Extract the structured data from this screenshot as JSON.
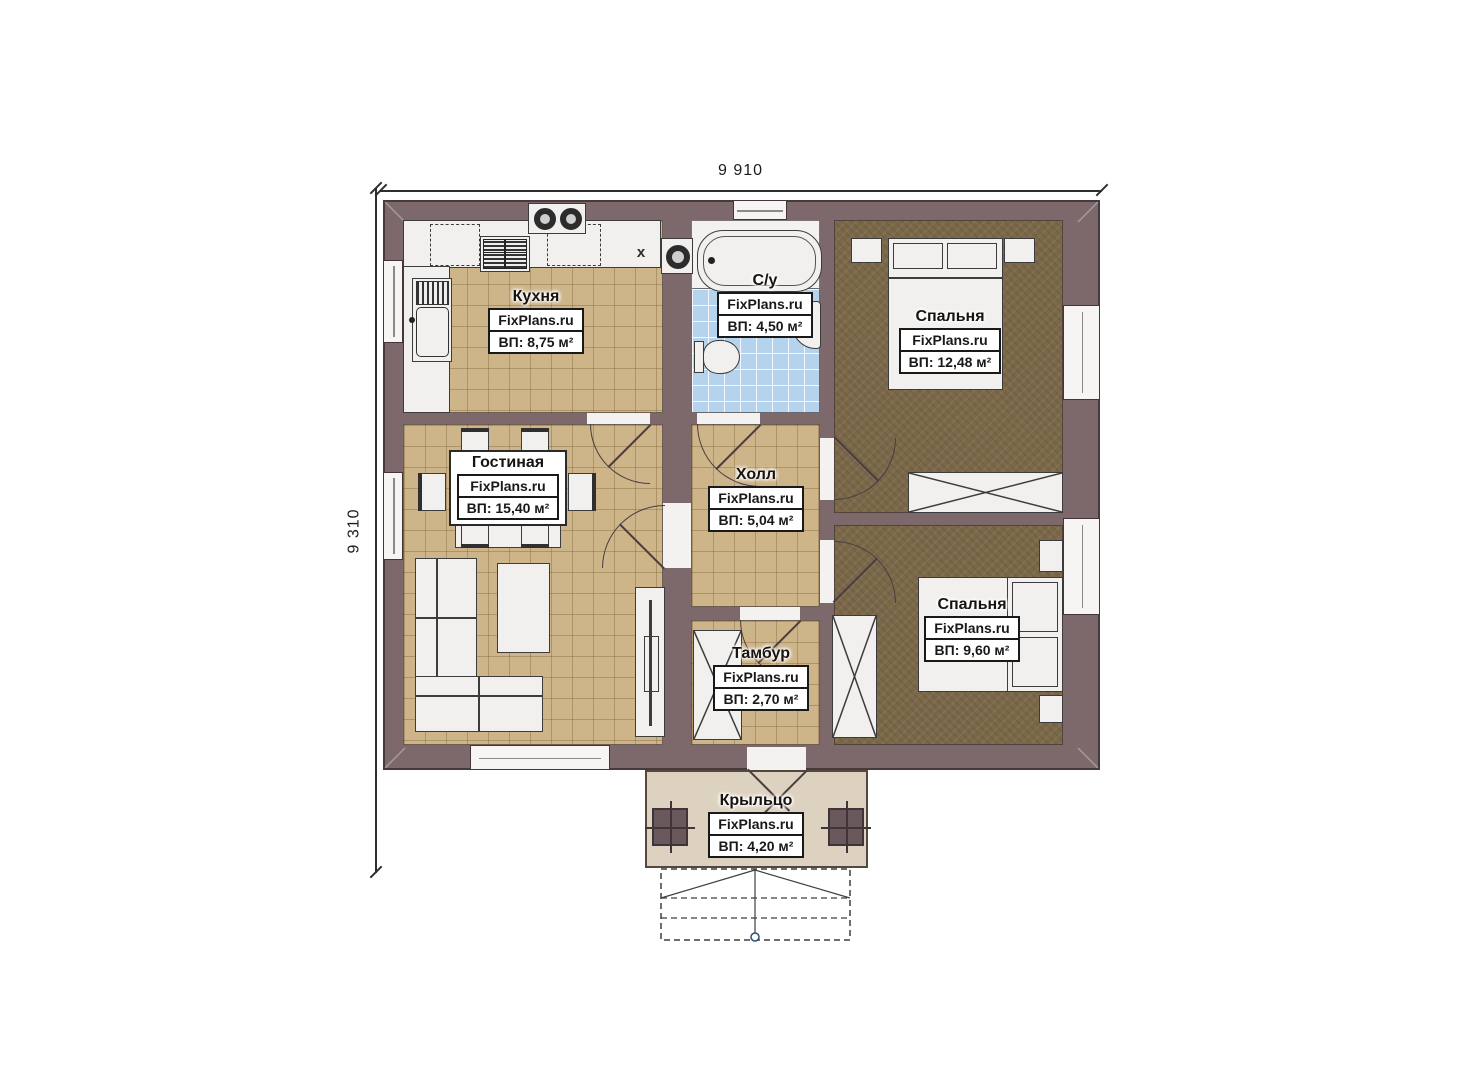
{
  "plan": {
    "dimensions": {
      "width_label": "9 910",
      "height_label": "9 310"
    },
    "watermark": "FixPlans.ru",
    "rooms": {
      "kitchen": {
        "name": "Кухня",
        "area": "ВП: 8,75 м²"
      },
      "bathroom": {
        "name": "С/у",
        "area": "ВП: 4,50 м²"
      },
      "bedroom1": {
        "name": "Спальня",
        "area": "ВП: 12,48 м²"
      },
      "living": {
        "name": "Гостиная",
        "area": "ВП: 15,40 м²"
      },
      "hall": {
        "name": "Холл",
        "area": "ВП: 5,04 м²"
      },
      "tambur": {
        "name": "Тамбур",
        "area": "ВП: 2,70 м²"
      },
      "bedroom2": {
        "name": "Спальня",
        "area": "ВП: 9,60 м²"
      },
      "porch": {
        "name": "Крыльцо",
        "area": "ВП: 4,20 м²"
      }
    },
    "annotations": {
      "sink_marker": "x"
    },
    "colors": {
      "wall": "#7d696c",
      "floor": "#cdb489",
      "bathroom_floor": "#b5d3ec",
      "bedroom_floor": "#7b6849",
      "porch": "#ddd2c0",
      "outline": "#463a3d",
      "furniture": "#f1f0ee"
    }
  }
}
